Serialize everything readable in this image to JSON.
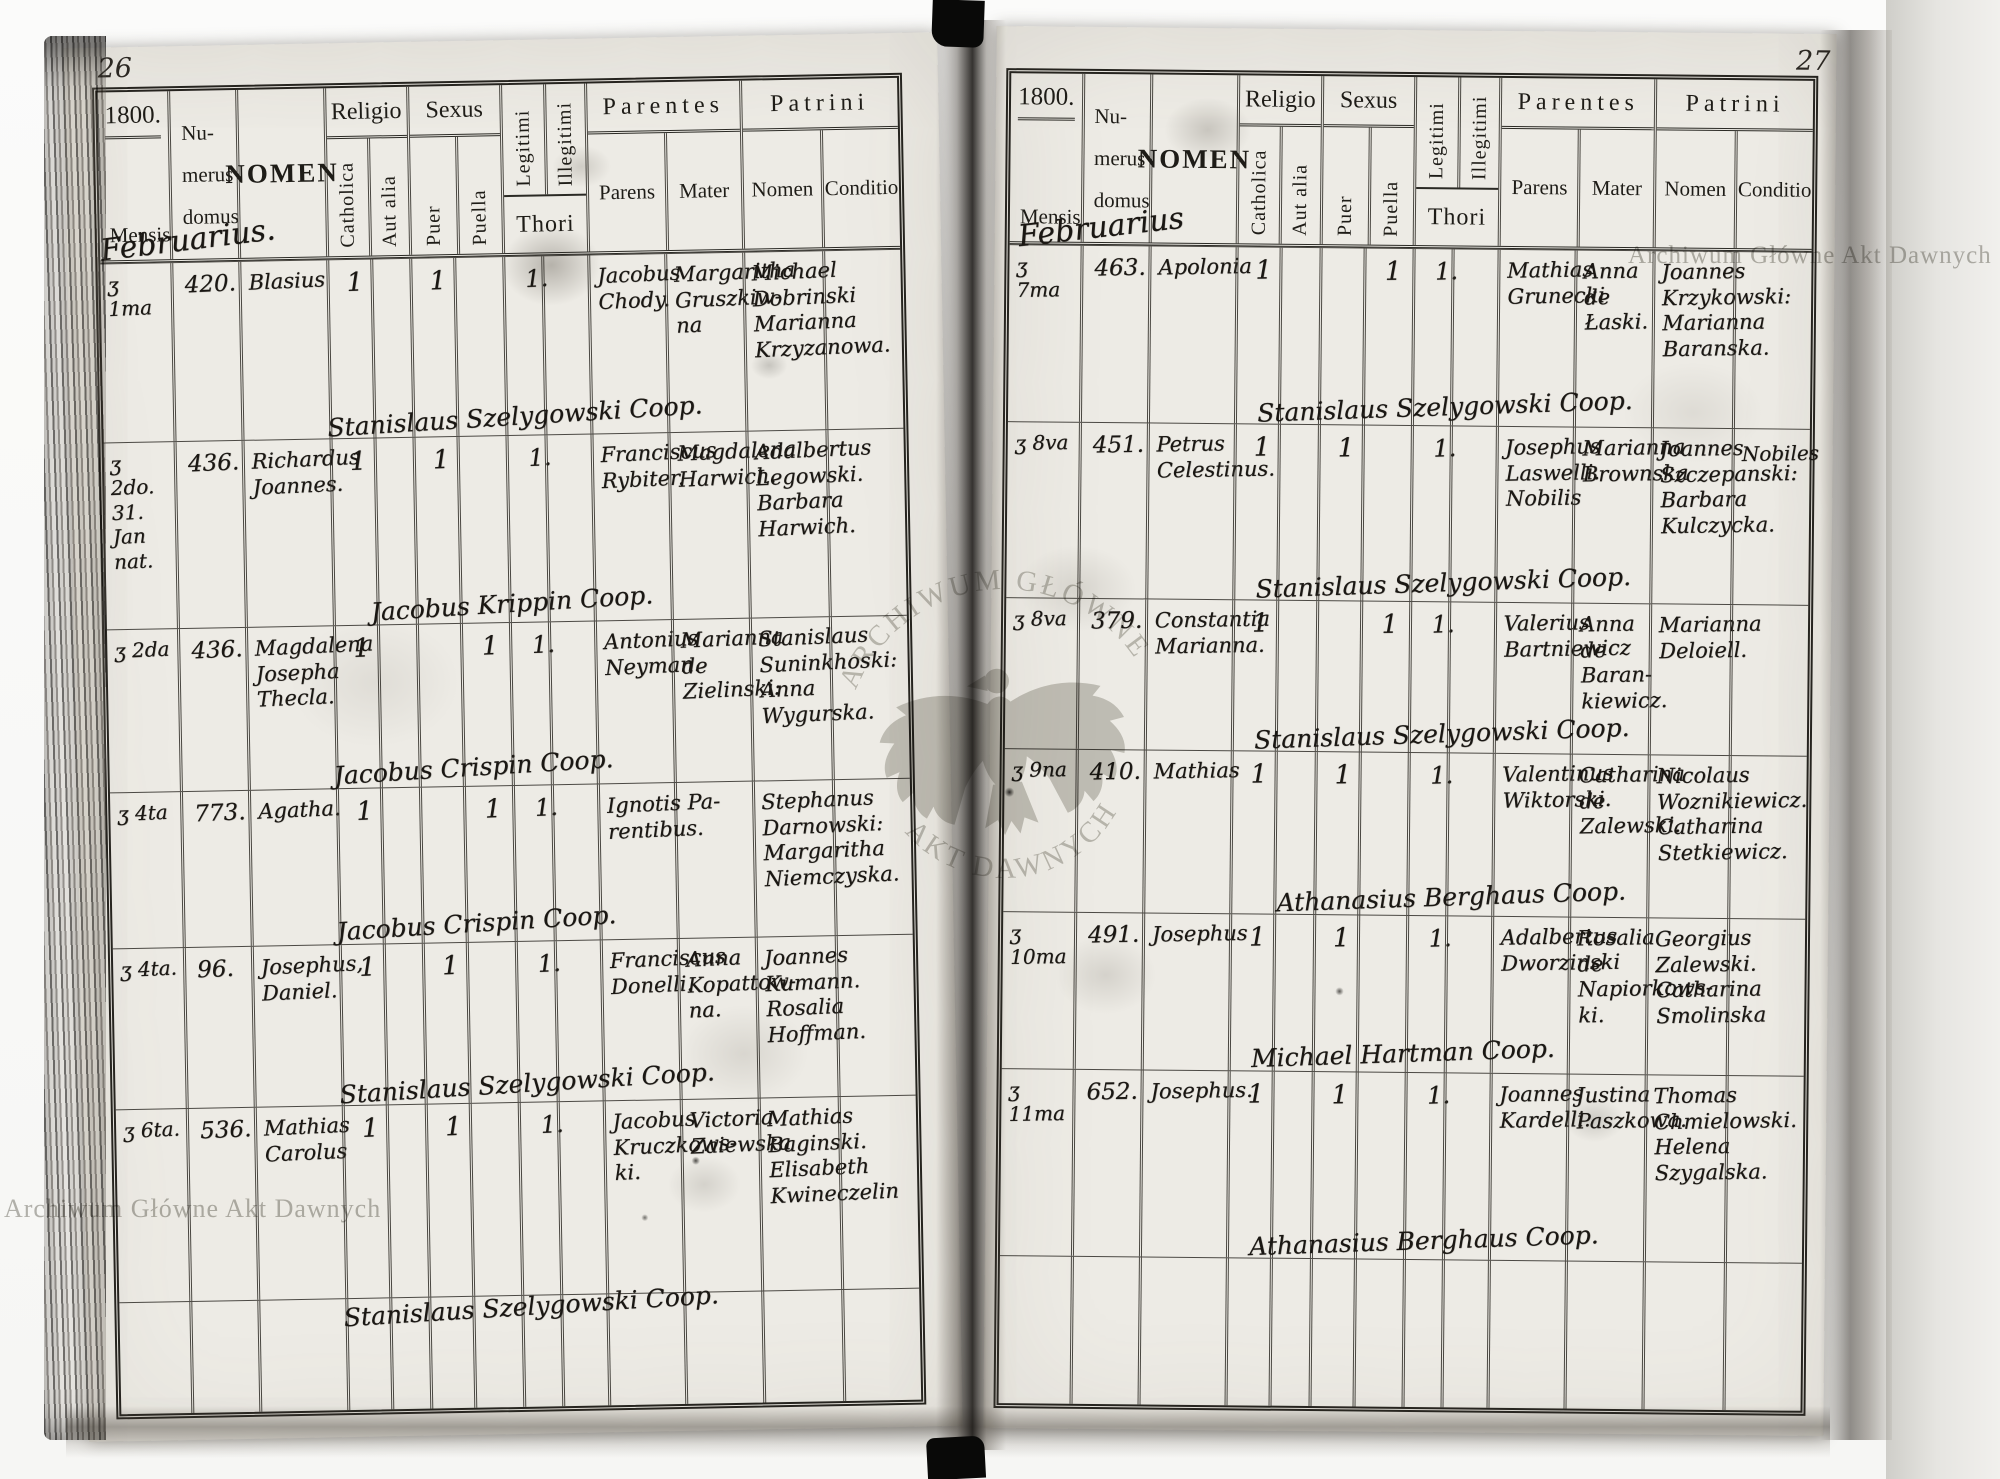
{
  "page_left": {
    "page_number": "26",
    "year": "1800.",
    "month": "Februarius.",
    "rows": [
      {
        "date": "ʒ 1ma",
        "house": "420.",
        "nomen": "Blasius",
        "catholica": "1",
        "puer": "1",
        "puella": "",
        "thori": "1.",
        "parens": "Jacobus\nChody.",
        "mater": "Margaritha\nGruszkiw-\nna",
        "patrini": "Michael\nDobrinski\nMarianna\nKrzyzanowa.",
        "conditio": "",
        "minister": "Stanislaus Szelygowski Coop."
      },
      {
        "date": "ʒ 2do.\n31.\nJan nat.",
        "house": "436.",
        "nomen": "Richardus\nJoannes.",
        "catholica": "1",
        "puer": "1",
        "puella": "",
        "thori": "1.",
        "parens": "Franciscus\nRybiter.",
        "mater": "Magdalena\nHarwich.",
        "patrini": "Adalbertus\nLegowski.\nBarbara\nHarwich.",
        "conditio": "",
        "minister": "Jacobus Krippin Coop."
      },
      {
        "date": "ʒ 2da",
        "house": "436.",
        "nomen": "Magdalena\nJosepha\nThecla.",
        "catholica": "1",
        "puer": "",
        "puella": "1",
        "thori": "1.",
        "parens": "Antonius\nNeyman.",
        "mater": "Marianna\nde\nZielinski:",
        "patrini": "Stanislaus\nSuninkhoski:\nAnna\nWygurska.",
        "conditio": "",
        "minister": "Jacobus Crispin Coop."
      },
      {
        "date": "ʒ 4ta",
        "house": "773.",
        "nomen": "Agatha.",
        "catholica": "1",
        "puer": "",
        "puella": "1",
        "thori": "1.",
        "parens": "Ignotis Pa-\nrentibus.",
        "mater": "",
        "patrini": "Stephanus\nDarnowski:\nMargaritha\nNiemczyska.",
        "conditio": "",
        "minister": "Jacobus Crispin Coop."
      },
      {
        "date": "ʒ 4ta.",
        "house": "96.",
        "nomen": "Josephus,\nDaniel.",
        "catholica": "1",
        "puer": "1",
        "puella": "",
        "thori": "1.",
        "parens": "Franciscus\nDonelli.",
        "mater": "Anna\nKopattow-\nna.",
        "patrini": "Joannes\nKumann.\nRosalia\nHoffman.",
        "conditio": "",
        "minister": "Stanislaus Szelygowski Coop."
      },
      {
        "date": "ʒ 6ta.",
        "house": "536.",
        "nomen": "Mathias\nCarolus",
        "catholica": "1",
        "puer": "1",
        "puella": "",
        "thori": "1.",
        "parens": "Jacobus\nKruczkows-\nki.",
        "mater": "Victoria\nZaiewska",
        "patrini": "Mathias\nBaginski.\nElisabeth\nKwineczelin",
        "conditio": "",
        "minister": "Stanislaus Szelygowski Coop."
      }
    ]
  },
  "page_right": {
    "page_number": "27",
    "year": "1800.",
    "month": "Februarius",
    "rows": [
      {
        "date": "ʒ 7ma",
        "house": "463.",
        "nomen": "Apolonia",
        "catholica": "1",
        "puer": "",
        "puella": "1",
        "thori": "1.",
        "parens": "Mathias\nGrunecki",
        "mater": "Anna\nde\nŁaski.",
        "patrini": "Joannes\nKrzykowski:\nMarianna\nBaranska.",
        "conditio": "",
        "minister": "Stanislaus Szelygowski Coop."
      },
      {
        "date": "ʒ 8va",
        "house": "451.",
        "nomen": "Petrus\nCelestinus.",
        "catholica": "1",
        "puer": "1",
        "puella": "",
        "thori": "1.",
        "parens": "Josephus\nLaswelli.\nNobilis",
        "mater": "Marianna\nBrownska",
        "patrini": "Joannes\nSzczepanski:\nBarbara\nKulczycka.",
        "conditio": "Nobiles",
        "minister": "Stanislaus Szelygowski Coop."
      },
      {
        "date": "ʒ 8va",
        "house": "379.",
        "nomen": "Constantia\nMarianna.",
        "catholica": "1",
        "puer": "",
        "puella": "1",
        "thori": "1.",
        "parens": "Valerius\nBartniewicz",
        "mater": "Anna\nde\nBaran-\nkiewicz.",
        "patrini": "Marianna\nDeloiell.",
        "conditio": "",
        "minister": "Stanislaus Szelygowski Coop."
      },
      {
        "date": "ʒ 9na",
        "house": "410.",
        "nomen": "Mathias",
        "catholica": "1",
        "puer": "1",
        "puella": "",
        "thori": "1.",
        "parens": "Valentinus\nWiktorski.",
        "mater": "Catharina\nde\nZalewski.",
        "patrini": "Nicolaus\nWoznikiewicz.\nCatharina\nStetkiewicz.",
        "conditio": "",
        "minister": "Athanasius Berghaus Coop."
      },
      {
        "date": "ʒ 10ma",
        "house": "491.",
        "nomen": "Josephus",
        "catholica": "1",
        "puer": "1",
        "puella": "",
        "thori": "1.",
        "parens": "Adalbertus\nDworzinski",
        "mater": "Rosalia\nde\nNapiorkows-\nki.",
        "patrini": "Georgius\nZalewski.\nCatharina\nSmolinska",
        "conditio": "",
        "minister": "Michael Hartman Coop."
      },
      {
        "date": "ʒ 11ma",
        "house": "652.",
        "nomen": "Josephus.",
        "catholica": "1",
        "puer": "1",
        "puella": "",
        "thori": "1.",
        "parens": "Joannes\nKardelli.",
        "mater": "Justina\nPaszkowa.",
        "patrini": "Thomas\nChmielowski.\nHelena\nSzygalska.",
        "conditio": "",
        "minister": "Athanasius Berghaus Coop."
      }
    ]
  },
  "headers": {
    "mensis": "Mensis",
    "numerus": "Nu-\nmerus\ndomus",
    "nomen": "NOMEN",
    "religio": "Religio",
    "catholica": "Catholica",
    "aut_alia": "Aut alia",
    "sexus": "Sexus",
    "puer": "Puer",
    "puella": "Puella",
    "legitimi": "Legitimi",
    "illegitimi": "Illegitimi",
    "thori": "Thori",
    "parentes": "Parentes",
    "parens": "Parens",
    "mater": "Mater",
    "patrini": "Patrini",
    "patrini_nomen": "Nomen",
    "conditio": "Conditio"
  },
  "watermarks": {
    "corner_text": "Archiwum Główne Akt Dawnych",
    "emblem_top": "ARCHIWUM GŁÓWNE",
    "emblem_bottom": "AKT DAWNYCH"
  }
}
